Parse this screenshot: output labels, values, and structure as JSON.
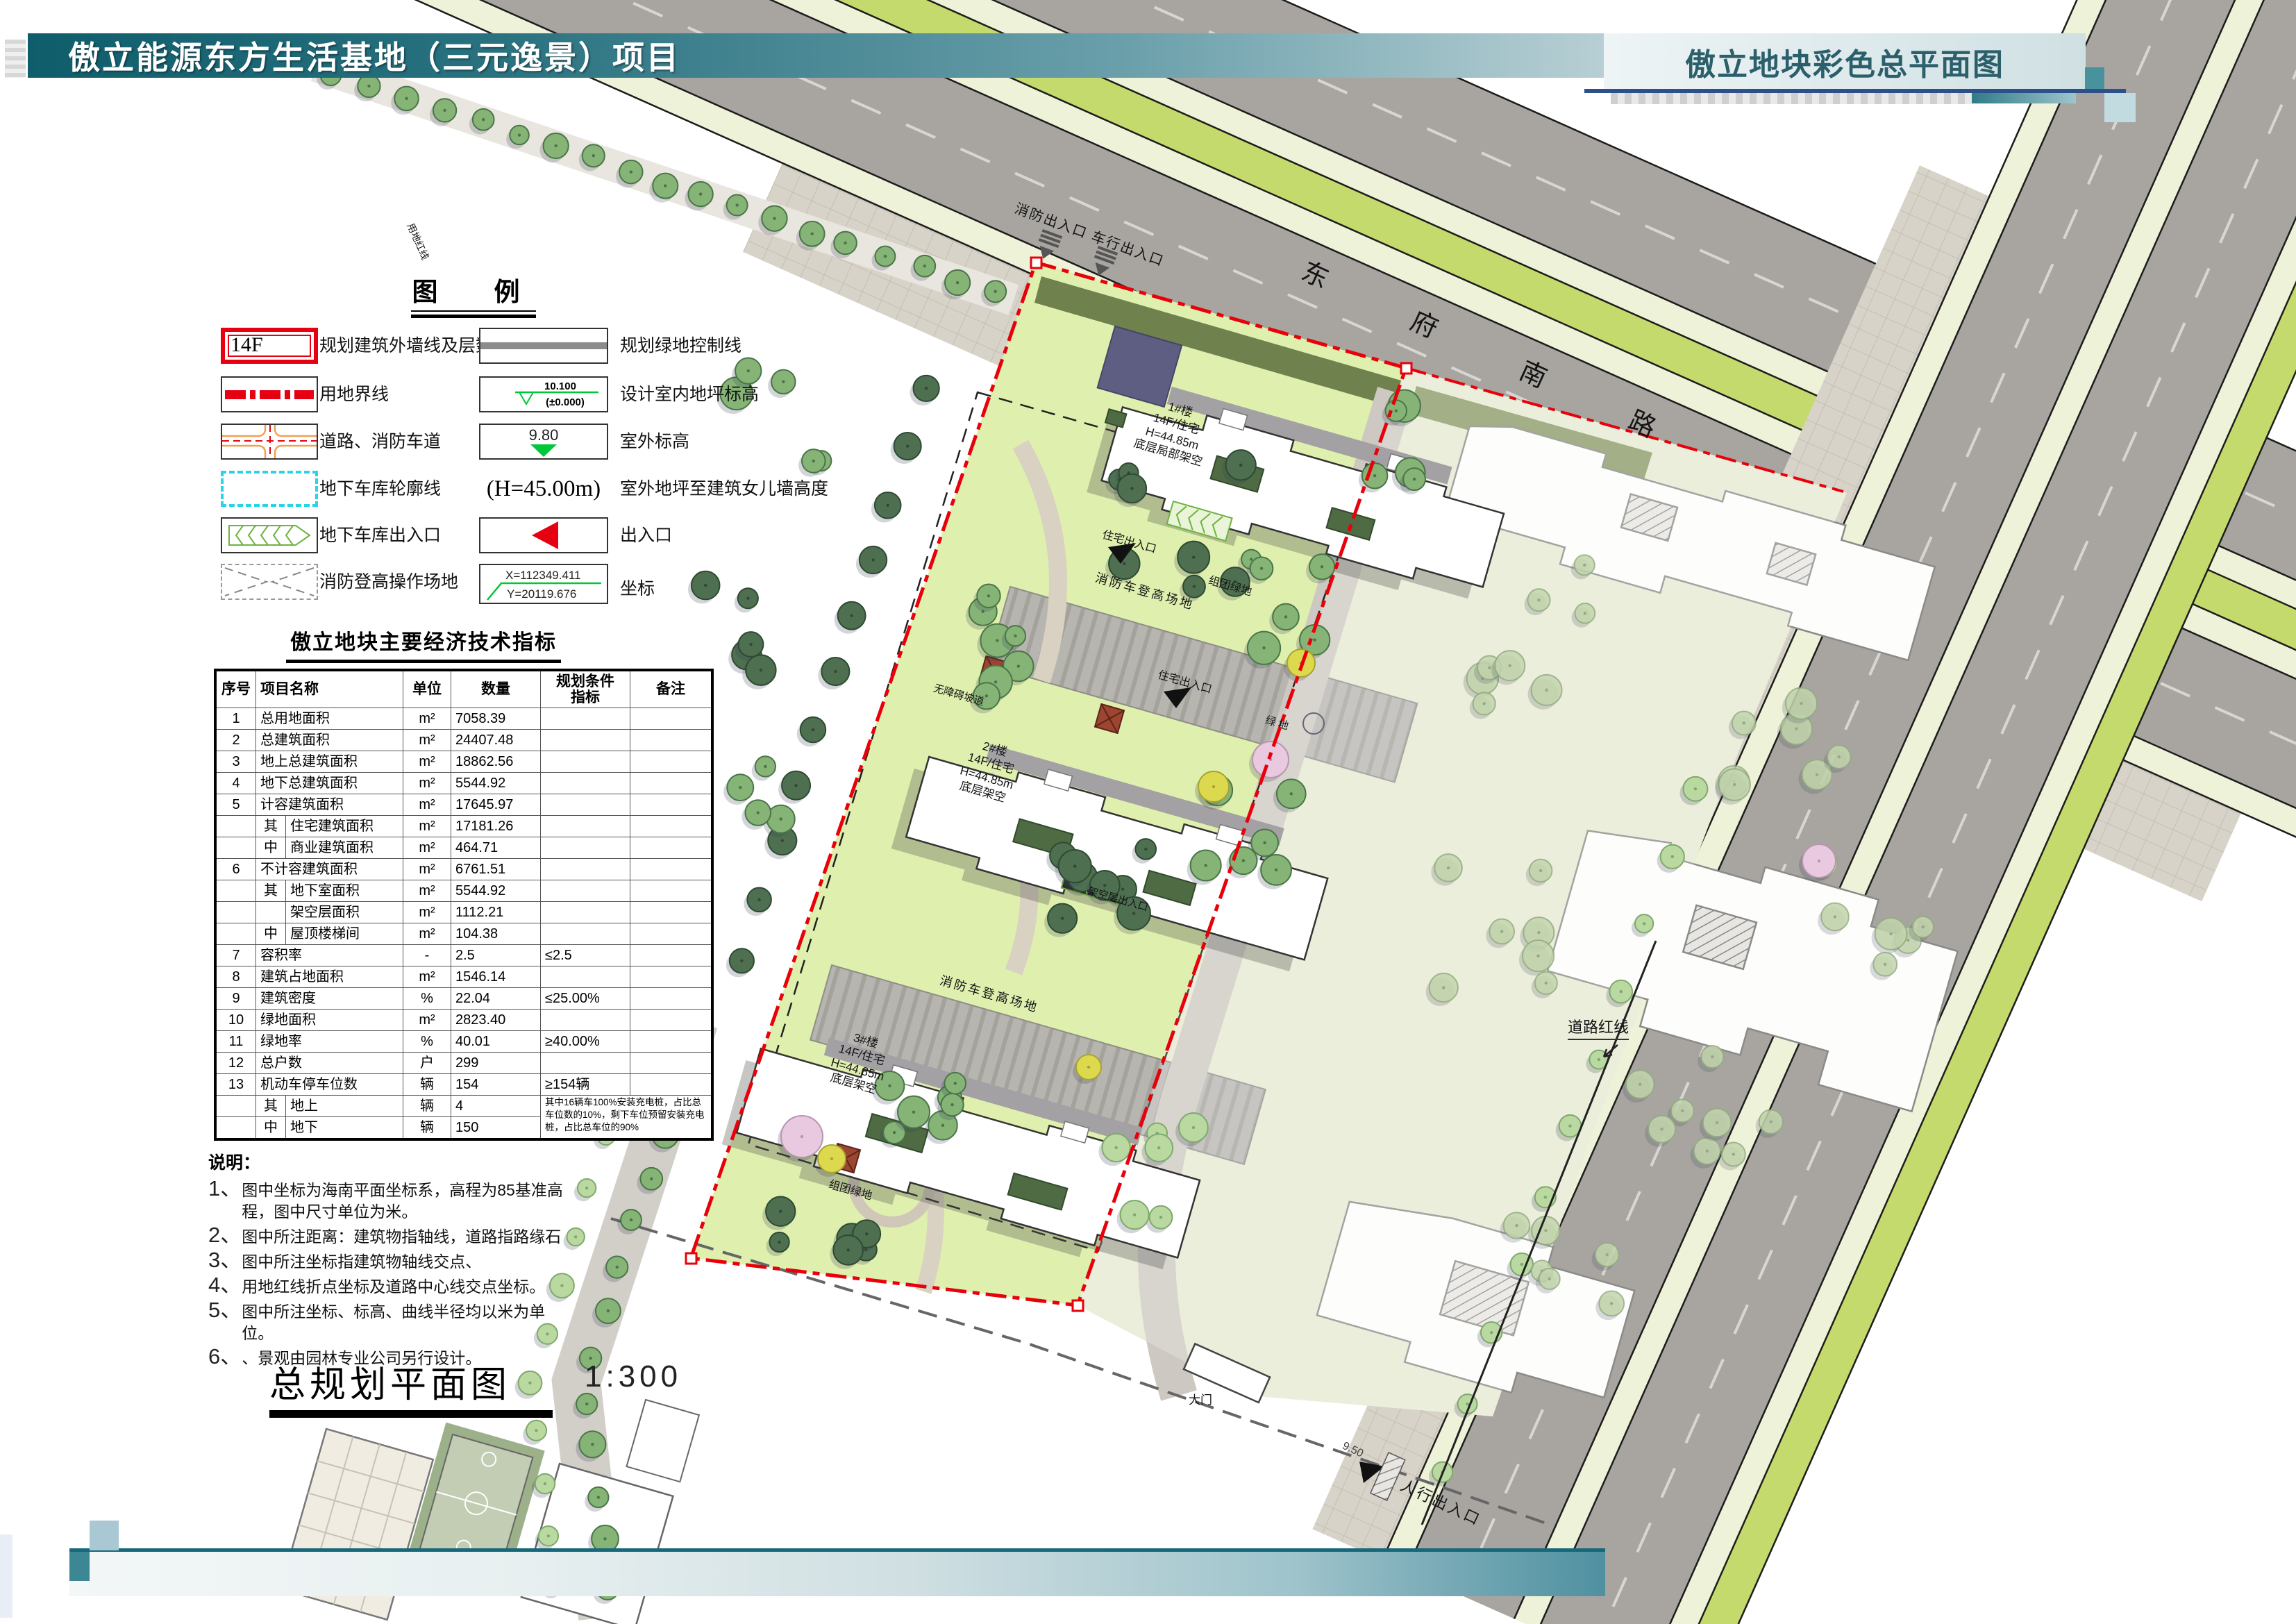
{
  "header": {
    "title": "傲立能源东方生活基地（三元逸景）项目",
    "right_title": "傲立地块彩色总平面图"
  },
  "legend": {
    "title": "图　例",
    "items_left": [
      {
        "symbol": "building-outline",
        "sample": "14F",
        "label": "规划建筑外墙线及层数"
      },
      {
        "symbol": "land-boundary",
        "label": "用地界线"
      },
      {
        "symbol": "road-fire-lane",
        "label": "道路、消防车道"
      },
      {
        "symbol": "garage-outline",
        "label": "地下车库轮廓线"
      },
      {
        "symbol": "garage-entrance",
        "label": "地下车库出入口"
      },
      {
        "symbol": "fire-operation-area",
        "label": "消防登高操作场地"
      }
    ],
    "items_right": [
      {
        "symbol": "green-control-line",
        "label": "规划绿地控制线"
      },
      {
        "symbol": "indoor-level",
        "value1": "10.100",
        "value2": "(±0.000)",
        "label": "设计室内地坪标高"
      },
      {
        "symbol": "outdoor-level",
        "value": "9.80",
        "label": "室外标高"
      },
      {
        "symbol": "parapet-height",
        "value": "(H=45.00m)",
        "label": "室外地坪至建筑女儿墙高度"
      },
      {
        "symbol": "entrance-arrow",
        "label": "出入口"
      },
      {
        "symbol": "coordinate",
        "x": "X=112349.411",
        "y": "Y=20119.676",
        "label": "坐标"
      }
    ]
  },
  "table": {
    "title": "傲立地块主要经济技术指标",
    "headers": {
      "no": "序号",
      "name": "项目名称",
      "unit": "单位",
      "qty": "数量",
      "cond": "规划条件\n指标",
      "note": "备注"
    },
    "rows": [
      {
        "no": "1",
        "prefix": "",
        "name": "总用地面积",
        "unit": "m²",
        "qty": "7058.39",
        "cond": "",
        "note": ""
      },
      {
        "no": "2",
        "prefix": "",
        "name": "总建筑面积",
        "unit": "m²",
        "qty": "24407.48",
        "cond": "",
        "note": ""
      },
      {
        "no": "3",
        "prefix": "",
        "name": "地上总建筑面积",
        "unit": "m²",
        "qty": "18862.56",
        "cond": "",
        "note": ""
      },
      {
        "no": "4",
        "prefix": "",
        "name": "地下总建筑面积",
        "unit": "m²",
        "qty": "5544.92",
        "cond": "",
        "note": ""
      },
      {
        "no": "5",
        "prefix": "",
        "name": "计容建筑面积",
        "unit": "m²",
        "qty": "17645.97",
        "cond": "",
        "note": ""
      },
      {
        "no": "",
        "prefix": "其",
        "name": "住宅建筑面积",
        "unit": "m²",
        "qty": "17181.26",
        "cond": "",
        "note": ""
      },
      {
        "no": "",
        "prefix": "中",
        "name": "商业建筑面积",
        "unit": "m²",
        "qty": "464.71",
        "cond": "",
        "note": ""
      },
      {
        "no": "6",
        "prefix": "",
        "name": "不计容建筑面积",
        "unit": "m²",
        "qty": "6761.51",
        "cond": "",
        "note": ""
      },
      {
        "no": "",
        "prefix": "其",
        "name": "地下室面积",
        "unit": "m²",
        "qty": "5544.92",
        "cond": "",
        "note": ""
      },
      {
        "no": "",
        "prefix": "",
        "name": "架空层面积",
        "unit": "m²",
        "qty": "1112.21",
        "cond": "",
        "note": ""
      },
      {
        "no": "",
        "prefix": "中",
        "name": "屋顶楼梯间",
        "unit": "m²",
        "qty": "104.38",
        "cond": "",
        "note": ""
      },
      {
        "no": "7",
        "prefix": "",
        "name": "容积率",
        "unit": "-",
        "qty": "2.5",
        "cond": "≤2.5",
        "note": ""
      },
      {
        "no": "8",
        "prefix": "",
        "name": "建筑占地面积",
        "unit": "m²",
        "qty": "1546.14",
        "cond": "",
        "note": ""
      },
      {
        "no": "9",
        "prefix": "",
        "name": "建筑密度",
        "unit": "%",
        "qty": "22.04",
        "cond": "≤25.00%",
        "note": ""
      },
      {
        "no": "10",
        "prefix": "",
        "name": "绿地面积",
        "unit": "m²",
        "qty": "2823.40",
        "cond": "",
        "note": ""
      },
      {
        "no": "11",
        "prefix": "",
        "name": "绿地率",
        "unit": "%",
        "qty": "40.01",
        "cond": "≥40.00%",
        "note": ""
      },
      {
        "no": "12",
        "prefix": "",
        "name": "总户数",
        "unit": "户",
        "qty": "299",
        "cond": "",
        "note": ""
      },
      {
        "no": "13",
        "prefix": "",
        "name": "机动车停车位数",
        "unit": "辆",
        "qty": "154",
        "cond": "≥154辆",
        "note": ""
      },
      {
        "no": "",
        "prefix": "其",
        "name": "地上",
        "unit": "辆",
        "qty": "4",
        "cond": "",
        "note": "其中16辆车100%安装充电桩，占比总车位数的10%，剩下车位预留安装充电桩，占比总车位的90%"
      },
      {
        "no": "",
        "prefix": "中",
        "name": "地下",
        "unit": "辆",
        "qty": "150",
        "cond": "",
        "note": ""
      }
    ]
  },
  "notes": {
    "title": "说明：",
    "items": [
      {
        "num": "1、",
        "text": "图中坐标为海南平面坐标系，高程为85基准高程，图中尺寸单位为米。"
      },
      {
        "num": "2、",
        "text": "图中所注距离：建筑物指轴线，道路指路缘石"
      },
      {
        "num": "3、",
        "text": "图中所注坐标指建筑物轴线交点、"
      },
      {
        "num": "4、",
        "text": "用地红线折点坐标及道路中心线交点坐标。"
      },
      {
        "num": "5、",
        "text": "图中所注坐标、标高、曲线半径均以米为单位。"
      },
      {
        "num": "6、",
        "text": "、景观由园林专业公司另行设计。"
      }
    ]
  },
  "plan_title": {
    "text": "总规划平面图",
    "scale": "1:300"
  },
  "plan": {
    "road_name": "东 府 南 路",
    "labels": {
      "entrance_top": "消防出入口 车行出入口",
      "red_line": "用地红线",
      "fire_lane": "消防车登高场地",
      "cluster_green": "组团绿地",
      "res_entrance": "住宅出入口",
      "stilt_entrance": "架空层出入口",
      "barrier_free": "无障碍坡道",
      "green": "绿地",
      "road_red_line": "道路红线",
      "gate": "大门",
      "ped_entrance": "人行出入口",
      "level_950": "9.50"
    },
    "buildings": [
      {
        "label": "1#楼\n14F/住宅\nH=44.85m\n底层局部架空"
      },
      {
        "label": "2#楼\n14F/住宅\nH=44.85m\n底层架空"
      },
      {
        "label": "3#楼\n14F/住宅\nH=44.85m\n底层架空"
      }
    ]
  },
  "colors": {
    "header_teal": "#0f5d6b",
    "boundary_red": "#e8000a",
    "lime_strip": "#c5da6c",
    "road_gray": "#a8a5a1",
    "lawn_green": "#dff0ae",
    "marker_green": "#00c838"
  }
}
